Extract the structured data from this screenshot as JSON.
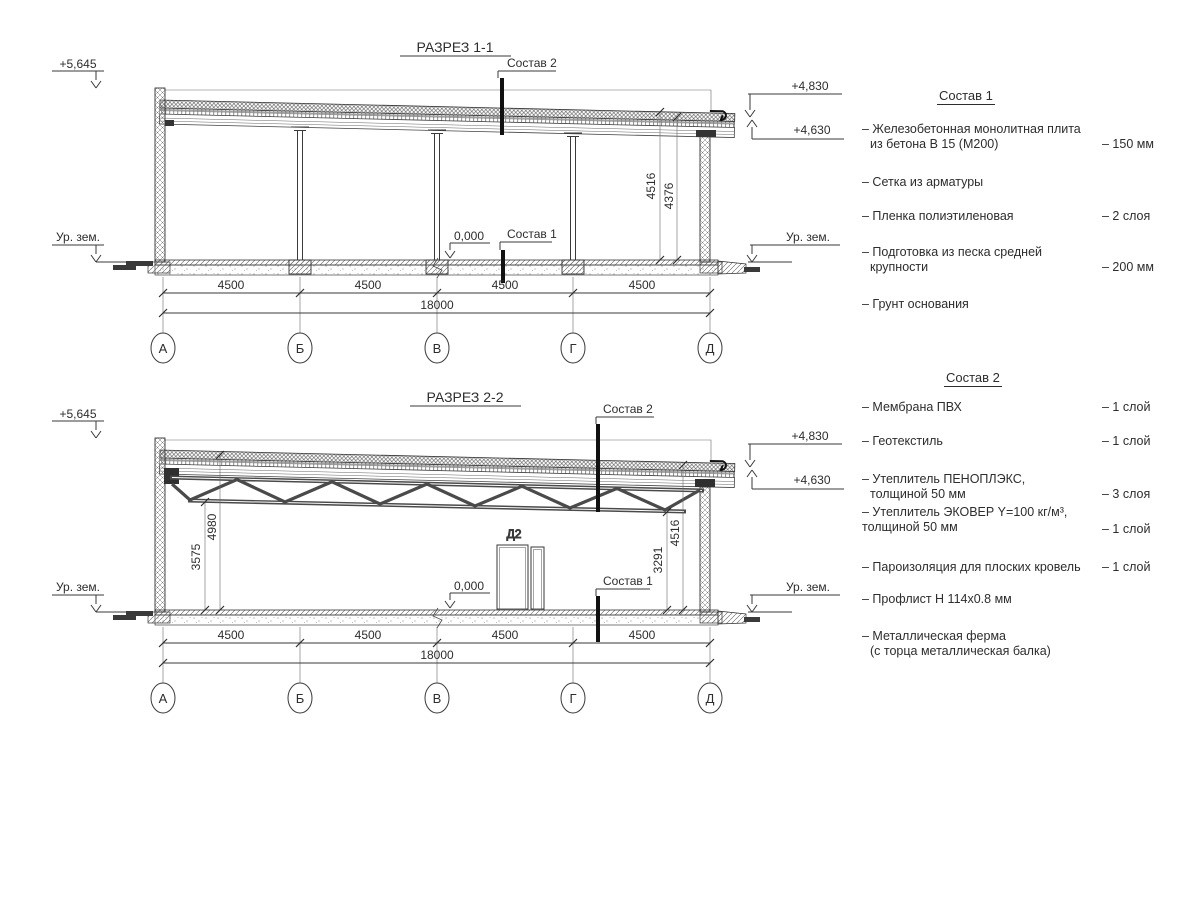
{
  "axes": [
    "А",
    "Б",
    "В",
    "Г",
    "Д"
  ],
  "dims": {
    "bay": "4500",
    "total": "18000"
  },
  "section1": {
    "title": "РАЗРЕЗ 1-1",
    "elev_parapet": "+5,645",
    "ground_label_left": "Ур. зем.",
    "ground_label_right": "Ур. зем.",
    "elev_roof_top": "+4,830",
    "elev_roof_low": "+4,630",
    "zero_mark": "0,000",
    "sostav2_label": "Состав 2",
    "sostav1_label": "Состав 1",
    "dim_height_1": "4516",
    "dim_height_2": "4376"
  },
  "section2": {
    "title": "РАЗРЕЗ 2-2",
    "elev_parapet": "+5,645",
    "ground_label_left": "Ур. зем.",
    "ground_label_right": "Ур. зем.",
    "elev_roof_top": "+4,830",
    "elev_roof_low": "+4,630",
    "zero_mark": "0,000",
    "sostav2_label": "Состав 2",
    "sostav1_label": "Состав 1",
    "door_label": "Д2",
    "dim_truss_bottom_left": "3575",
    "dim_ceiling_left": "4980",
    "dim_truss_bottom_right": "3291",
    "dim_roof_right": "4516"
  },
  "composition1": {
    "heading": "Состав 1",
    "items": [
      {
        "text": "– Железобетонная  монолитная плита",
        "text2": "из бетона В 15 (М200)",
        "value": "– 150 мм"
      },
      {
        "text": "– Сетка из арматуры",
        "text2": "",
        "value": ""
      },
      {
        "text": "– Пленка полиэтиленовая",
        "text2": "",
        "value": "– 2 слоя"
      },
      {
        "text": "– Подготовка из песка средней",
        "text2": "крупности",
        "value": "– 200 мм"
      },
      {
        "text": "– Грунт основания",
        "text2": "",
        "value": ""
      }
    ]
  },
  "composition2": {
    "heading": "Состав 2",
    "items": [
      {
        "text": "– Мембрана ПВХ",
        "text2": "",
        "value": "– 1 слой"
      },
      {
        "text": "– Геотекстиль",
        "text2": "",
        "value": "– 1 слой"
      },
      {
        "text": "– Утеплитель ПЕНОПЛЭКС,",
        "text2": "толщиной 50 мм",
        "value": "– 3 слоя"
      },
      {
        "text": "– Утеплитель ЭКОВЕР Y=100 кг/м³,",
        "text2": "толщиной 50 мм",
        "value": "– 1 слой"
      },
      {
        "text": "– Пароизоляция для плоских кровель",
        "text2": "",
        "value": "– 1 слой"
      },
      {
        "text": "– Профлист Н 114х0.8 мм",
        "text2": "",
        "value": ""
      },
      {
        "text": "– Металлическая ферма",
        "text2": "(с торца металлическая балка)",
        "value": ""
      }
    ]
  }
}
